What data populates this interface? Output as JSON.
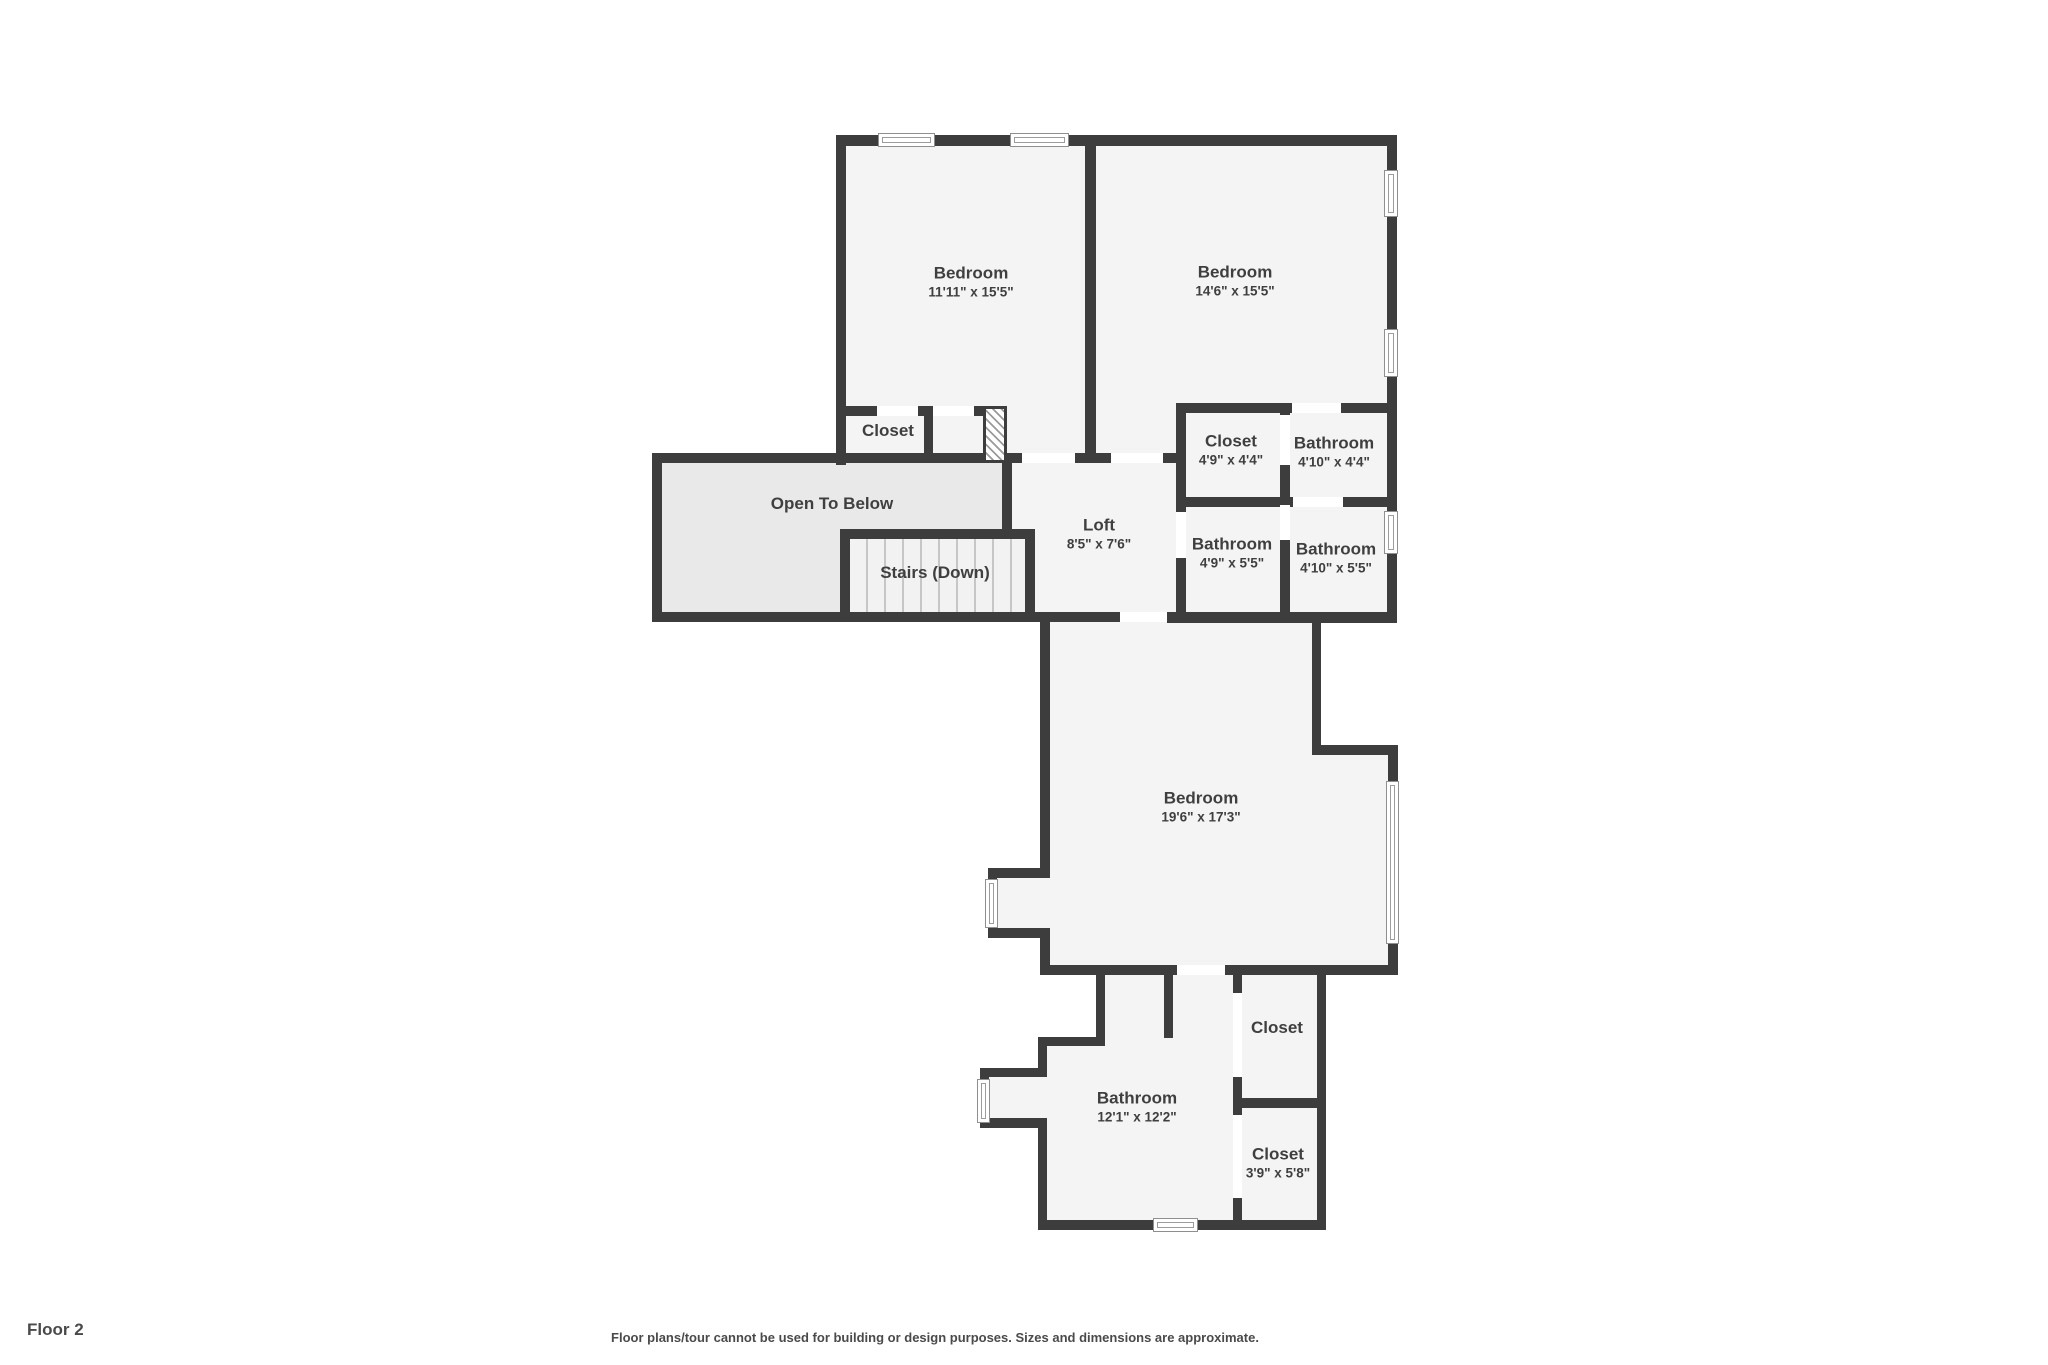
{
  "plan": {
    "title": "Floor 2",
    "disclaimer": "Floor plans/tour cannot be used for building or design purposes. Sizes and dimensions are approximate.",
    "rooms": [
      {
        "name": "Bedroom",
        "dims": "11'11\" x 15'5\""
      },
      {
        "name": "Bedroom",
        "dims": "14'6\" x 15'5\""
      },
      {
        "name": "Closet",
        "dims": ""
      },
      {
        "name": "Closet",
        "dims": "4'9\" x 4'4\""
      },
      {
        "name": "Bathroom",
        "dims": "4'10\" x 4'4\""
      },
      {
        "name": "Open To Below",
        "dims": ""
      },
      {
        "name": "Loft",
        "dims": "8'5\" x 7'6\""
      },
      {
        "name": "Bathroom",
        "dims": "4'9\" x 5'5\""
      },
      {
        "name": "Bathroom",
        "dims": "4'10\" x 5'5\""
      },
      {
        "name": "Stairs (Down)",
        "dims": ""
      },
      {
        "name": "Bedroom",
        "dims": "19'6\" x 17'3\""
      },
      {
        "name": "Closet",
        "dims": ""
      },
      {
        "name": "Bathroom",
        "dims": "12'1\" x 12'2\""
      },
      {
        "name": "Closet",
        "dims": "3'9\" x 5'8\""
      }
    ],
    "colors": {
      "wall": "#3d3d3d",
      "floor": "#f4f4f4",
      "open_to_below_fill": "#e9e9e9",
      "text": "#3f3f3f",
      "background": "#ffffff"
    }
  }
}
